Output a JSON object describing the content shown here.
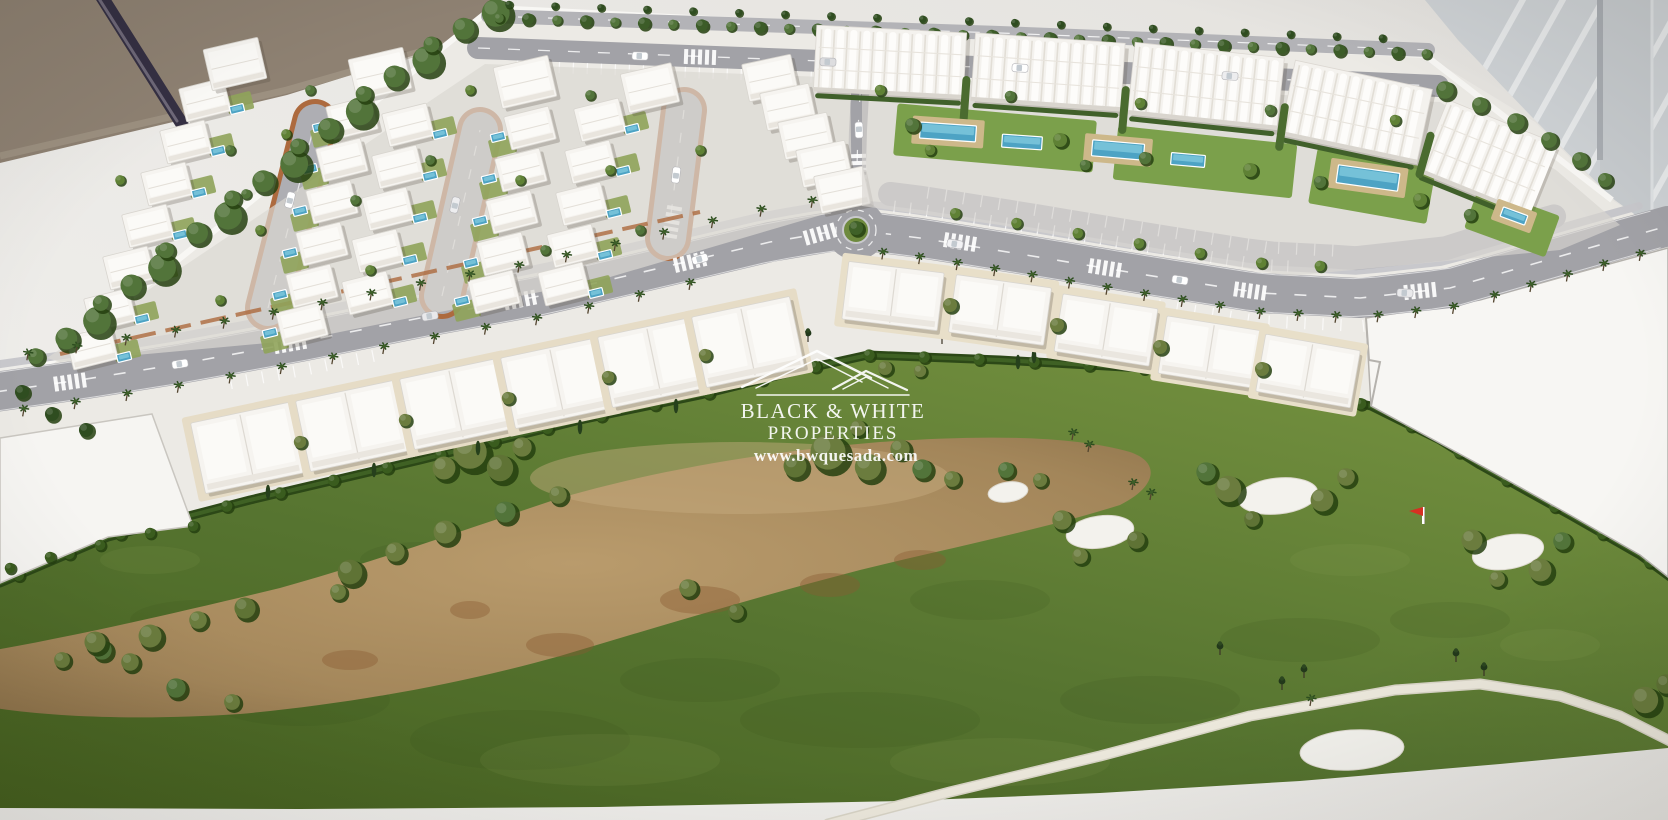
{
  "watermark": {
    "brand_line1": "BLACK & WHITE",
    "brand_line2": "PROPERTIES",
    "website": "www.bwquesada.com",
    "text_color": "#ffffff"
  },
  "palette": {
    "table_white": "#eceae6",
    "floor_tan": "#8e8172",
    "window_grey": "#ced2d5",
    "model_base": "#eceae5",
    "road_grey": "#a2a2a7",
    "minor_road_grey": "#aeaeb3",
    "brick_edging": "#ad6a3e",
    "building_white": "#f6f4f0",
    "pool_blue": "#4da3c4",
    "grass_light": "#74913f",
    "grass_mid": "#567430",
    "grass_dark": "#46611f",
    "garden_green": "#7ba04b",
    "waste_sand": "#a98c5e",
    "bunker_white": "#f3f2ed",
    "cart_path": "#ece8dc",
    "flag_red": "#d63022",
    "tree_dark_green": "#2f4d20",
    "tree_mid_green": "#52743a",
    "tree_olive": "#6b7c3e",
    "hedge_green": "#2c4817",
    "deck_tan": "#cdb88a"
  }
}
